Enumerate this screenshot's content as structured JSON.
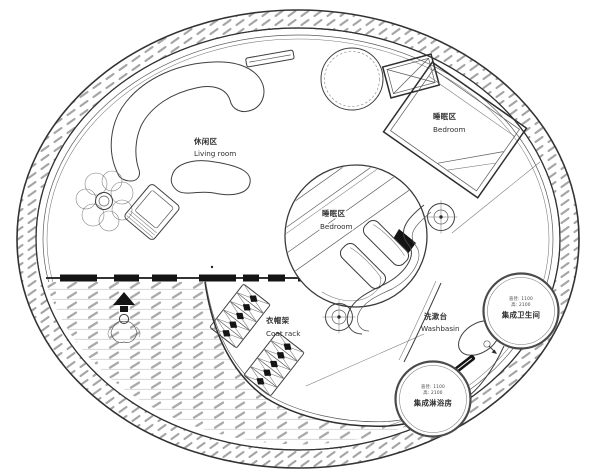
{
  "plan": {
    "type": "circular-house-floor-plan",
    "labels": {
      "living_zh": "休闲区",
      "living_en": "Living room",
      "bedroom_main_zh": "睡眠区",
      "bedroom_main_en": "Bedroom",
      "bedroom_center_zh": "睡眠区",
      "bedroom_center_en": "Bedroom",
      "coatrack_zh": "衣帽架",
      "coatrack_en": "Coat rack",
      "washbasin_zh": "洗漱台",
      "washbasin_en": "Washbasin",
      "bathroom_name": "集成卫生间",
      "bathroom_dim1": "直径: 1100",
      "bathroom_dim2": "高: 2100",
      "shower_name": "集成淋浴房",
      "shower_dim1": "直径: 1100",
      "shower_dim2": "高: 2100"
    },
    "symbols": {
      "ceiling_light": "crosshair-target",
      "entry": "entrance-arrow-and-person",
      "crossed_box": "equipment-box-x",
      "plant": "potted-plant",
      "faucet": "basin-tap-arrow"
    },
    "colors": {
      "line": "#3f3f3f",
      "wall_hatch": "#a5a5a5",
      "deck_line": "#d8d8d8",
      "deck_hatch": "#aaaaaa",
      "black_fill": "#141414",
      "background": "#ffffff"
    }
  }
}
